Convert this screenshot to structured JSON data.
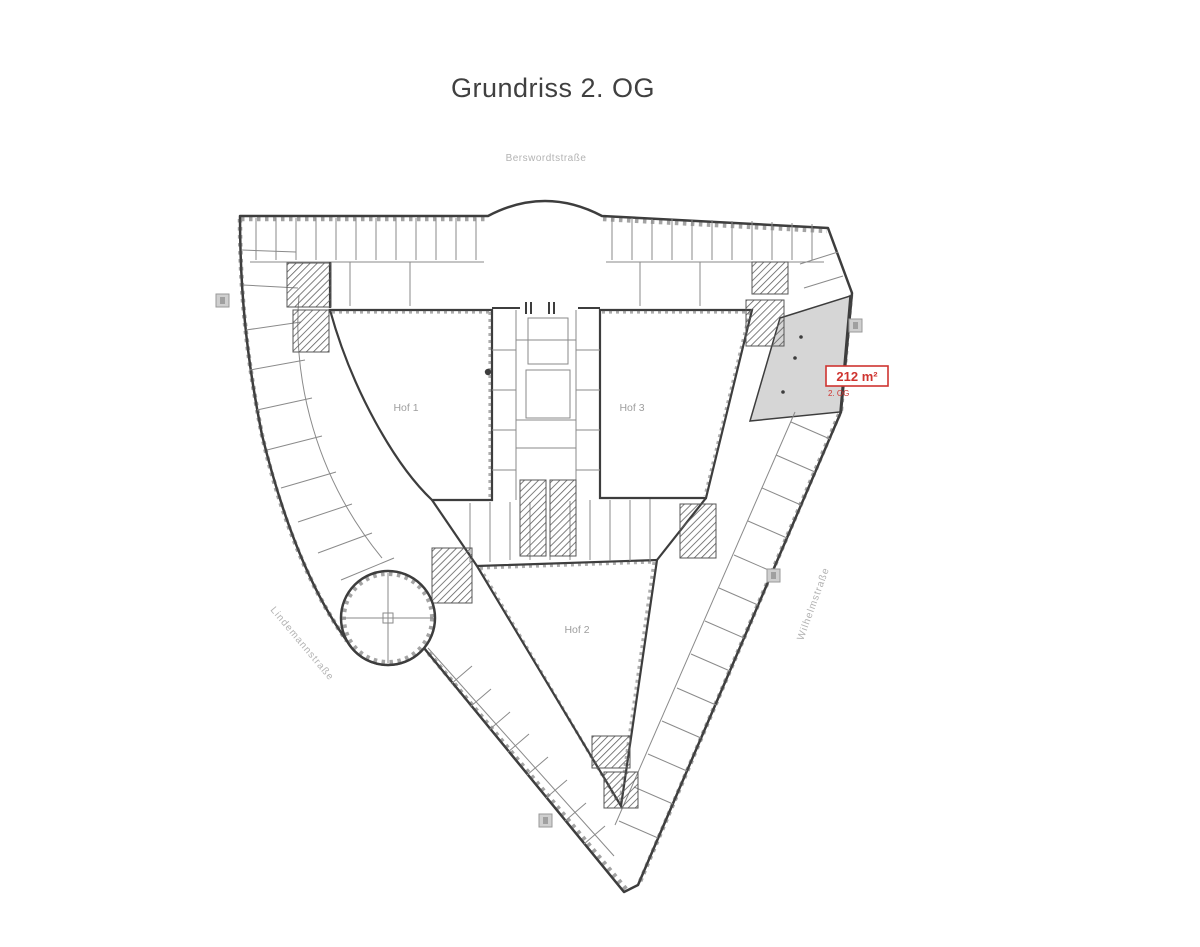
{
  "title": "Grundriss 2. OG",
  "streets": {
    "top": "Berswordtstraße",
    "left": "Lindemannstraße",
    "right": "Wilhelmstraße"
  },
  "courtyards": {
    "hof1": "Hof 1",
    "hof2": "Hof 2",
    "hof3": "Hof 3"
  },
  "highlight": {
    "area": "212 m²",
    "floor": "2. OG"
  },
  "colors": {
    "wall": "#3d3d3d",
    "interior_line": "#8a8a8a",
    "street_label": "#b3b3b3",
    "courtyard_label": "#9e9e9e",
    "highlight_fill": "#d6d6d6",
    "highlight_red": "#cf3430",
    "title": "#404040"
  }
}
